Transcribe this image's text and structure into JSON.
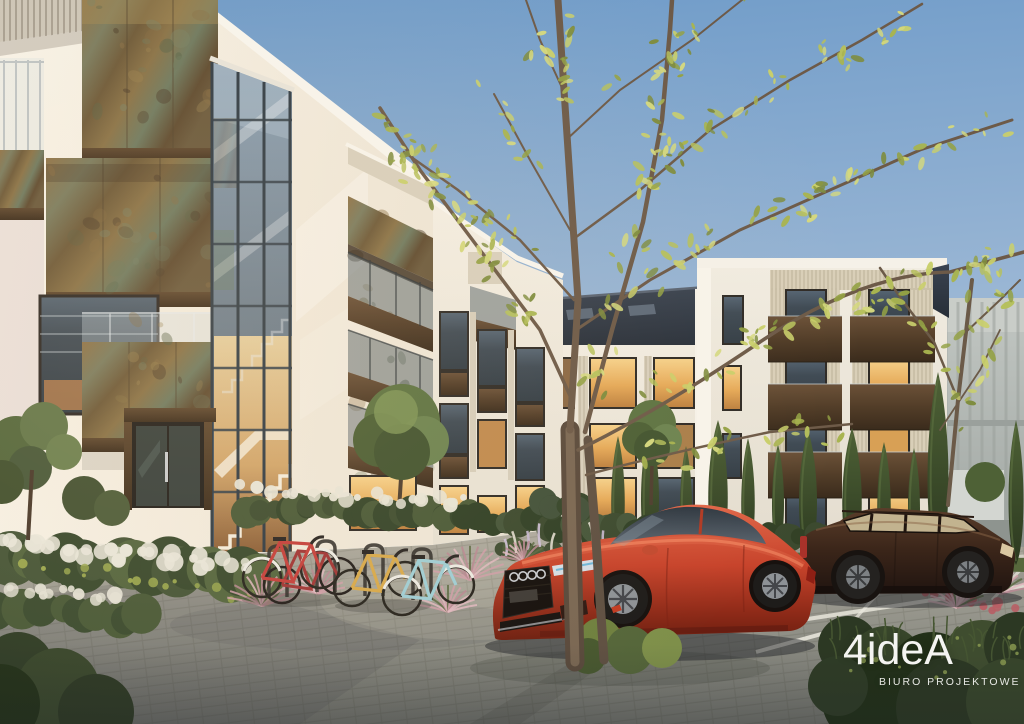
{
  "watermark": {
    "brand": "4ideA",
    "tagline": "BIURO PROJEKTOWE"
  },
  "scene": {
    "description": "Dusk architectural visualization of a modern residential courtyard",
    "elements": [
      "white apartment buildings with weathered corten steel balconies",
      "glazed stairwell with warm-lit white stairs",
      "paved courtyard",
      "red sportback car parked by a young tree",
      "dark brown estate car in marked parking bays",
      "bicycle racks with red, yellow and light-blue bicycles",
      "young tree with sparse yellow-green foliage",
      "ornamental pink grasses and white flowering shrubs",
      "tall cypress trees along the facade",
      "grey background building"
    ],
    "bicycle_count": 4
  },
  "palette": {
    "sky_top": "#6d9ac8",
    "sky_horizon": "#d7e0e8",
    "facade_white": "#f4f0e7",
    "facade_shadow": "#ddd4d2",
    "corten_rust": "#86693f",
    "corten_patina": "#75805f",
    "corten_dark": "#55402b",
    "window_glass": "#3f4a54",
    "window_warm_light": "#e8b264",
    "dark_roof": "#303845",
    "paving_light": "#a8a59a",
    "paving_shadow": "#73746e",
    "foliage_green": "#55683c",
    "foliage_yellow_green": "#b4bf5a",
    "grass_pink": "#c79da6",
    "flower_white": "#e7e4d7",
    "car_red": "#c6472e",
    "car_brown": "#402b20",
    "bike_red": "#c4403c",
    "bike_yellow": "#d7a94c",
    "bike_blue": "#9fcdd4",
    "watermark_text": "#f4f4f1"
  }
}
